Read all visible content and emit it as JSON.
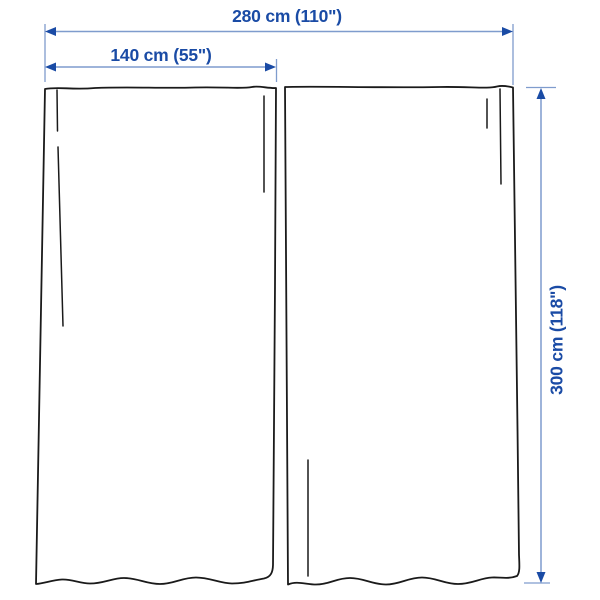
{
  "diagram": {
    "type": "product-dimension-diagram",
    "subject": "pair of curtain panels",
    "panels": 2,
    "labels": {
      "total_width": "280 cm (110\")",
      "panel_width": "140 cm (55\")",
      "height": "300 cm (118\")"
    },
    "measurements": {
      "total_width_cm": 280,
      "total_width_in": 110,
      "panel_width_cm": 140,
      "panel_width_in": 55,
      "height_cm": 300,
      "height_in": 118
    },
    "colors": {
      "dimension_text": "#1a4ba5",
      "dimension_line": "#7f9ccd",
      "arrowhead": "#1a4ba5",
      "outline": "#1a1a1a",
      "background": "#ffffff"
    }
  }
}
